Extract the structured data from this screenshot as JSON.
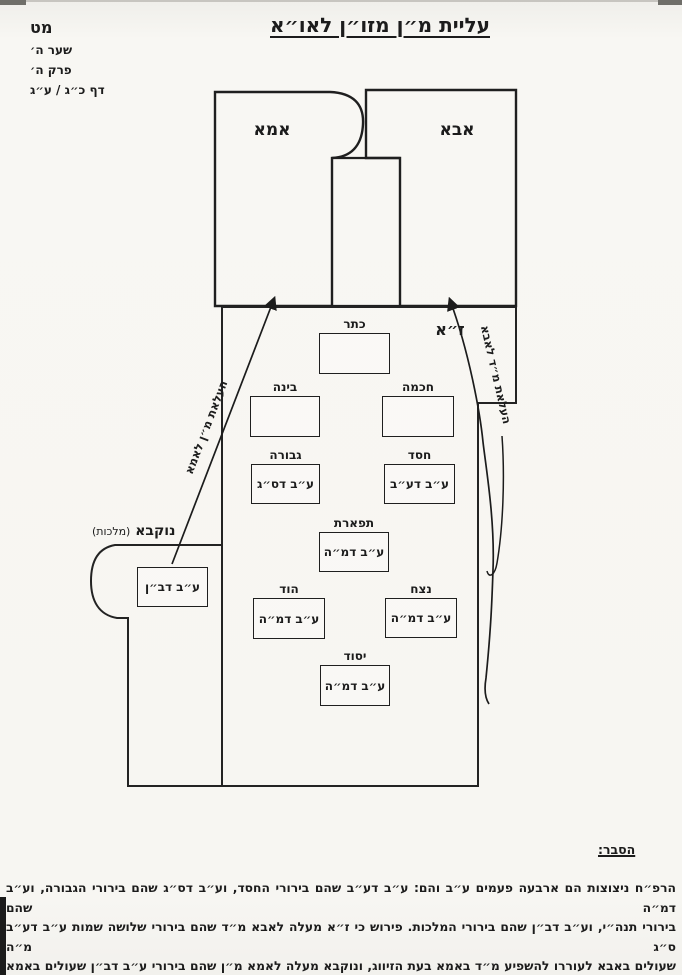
{
  "page_header": {
    "page_number": "מט",
    "gate": "שער ה׳",
    "chapter": "פרק ה׳",
    "folio": "דף כ״ג / ע״ג"
  },
  "title": "עליית מ״ן מזו״ן לאו״א",
  "diagram": {
    "regions": {
      "ima": "אמא",
      "abba": "אבא",
      "za": "ז״א",
      "nukva_name": "נוקבא",
      "nukva_qualifier": "(מלכות)"
    },
    "sefirot": [
      {
        "label": "כתר",
        "value": ""
      },
      {
        "label": "חכמה",
        "value": ""
      },
      {
        "label": "בינה",
        "value": ""
      },
      {
        "label": "חסד",
        "value": "ע״ב דע״ב"
      },
      {
        "label": "גבורה",
        "value": "ע״ב דס״ג"
      },
      {
        "label": "תפארת",
        "value": "ע״ב דמ״ה"
      },
      {
        "label": "נצח",
        "value": "ע״ב דמ״ה"
      },
      {
        "label": "הוד",
        "value": "ע״ב דמ״ה"
      },
      {
        "label": "יסוד",
        "value": "ע״ב דמ״ה"
      }
    ],
    "nukva_box_value": "ע״ב דב״ן",
    "arrows": {
      "left_label": "העלאת מ״ן לאמא",
      "right_label": "העלאת מ״ד לאבא"
    }
  },
  "explanation": {
    "heading": "הסבר:",
    "lines": [
      "הרפ״ח ניצוצות הם ארבעה פעמים ע״ב והם: ע״ב דע״ב שהם בירורי החסד, וע״ב דס״ג שהם בירורי הגבורה, וע״ב דמ״ה שהם",
      "בירורי תנה״י, וע״ב דב״ן שהם בירורי המלכות. פירוש כי ז״א מעלה לאבא מ״ד שהם בירורי שלושה שמות ע״ב דע״ב ס״ג מ״ה",
      "שעולים באבא לעוררו להשפיע מ״ד באמא בעת הזיווג, ונוקבא מעלה לאמא מ״ן שהם בירורי ע״ב דב״ן שעולים באמא לעוררה",
      "להעלות מ״ן בעת הזיווג."
    ]
  },
  "colors": {
    "ink": "#1c1c1c",
    "paper": "#f7f6f2"
  }
}
